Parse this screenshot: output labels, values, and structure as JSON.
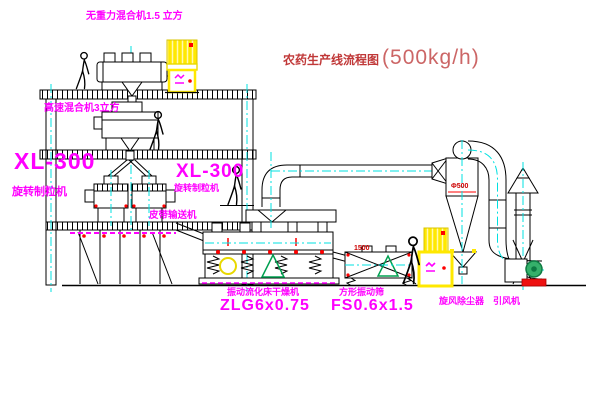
{
  "title": {
    "name": "农药生产线流程图",
    "capacity": "(500kg/h)"
  },
  "equipment_labels": {
    "gravity_free_mixer": "无重力混合机1.5 立方",
    "high_speed_mixer": "高速混合机3立方",
    "granulator_left_model": "XL-300",
    "granulator_left_name": "旋转制粒机",
    "granulator_right_model": "XL-300",
    "granulator_right_name": "旋转制粒机",
    "belt_conveyor": "皮带输送机",
    "fluid_bed_dryer_name": "振动流化床干燥机",
    "fluid_bed_dryer_model": "ZLG6x0.75",
    "square_sieve_name": "方形振动筛",
    "square_sieve_model": "FS0.6x1.5",
    "cyclone_dust_collector": "旋风除尘器",
    "induced_draft_fan": "引风机"
  },
  "dimensions": {
    "cyclone_diameter": "Φ500",
    "sieve_length": "1500"
  },
  "colors": {
    "background": "#ffffff",
    "line_black": "#000000",
    "centerline_cyan": "#00e0e0",
    "label_magenta": "#ff00ff",
    "title_red": "#c03838",
    "cabinet_yellow": "#ffe800",
    "accent_red": "#ff0000",
    "fan_green": "#35b06a"
  }
}
